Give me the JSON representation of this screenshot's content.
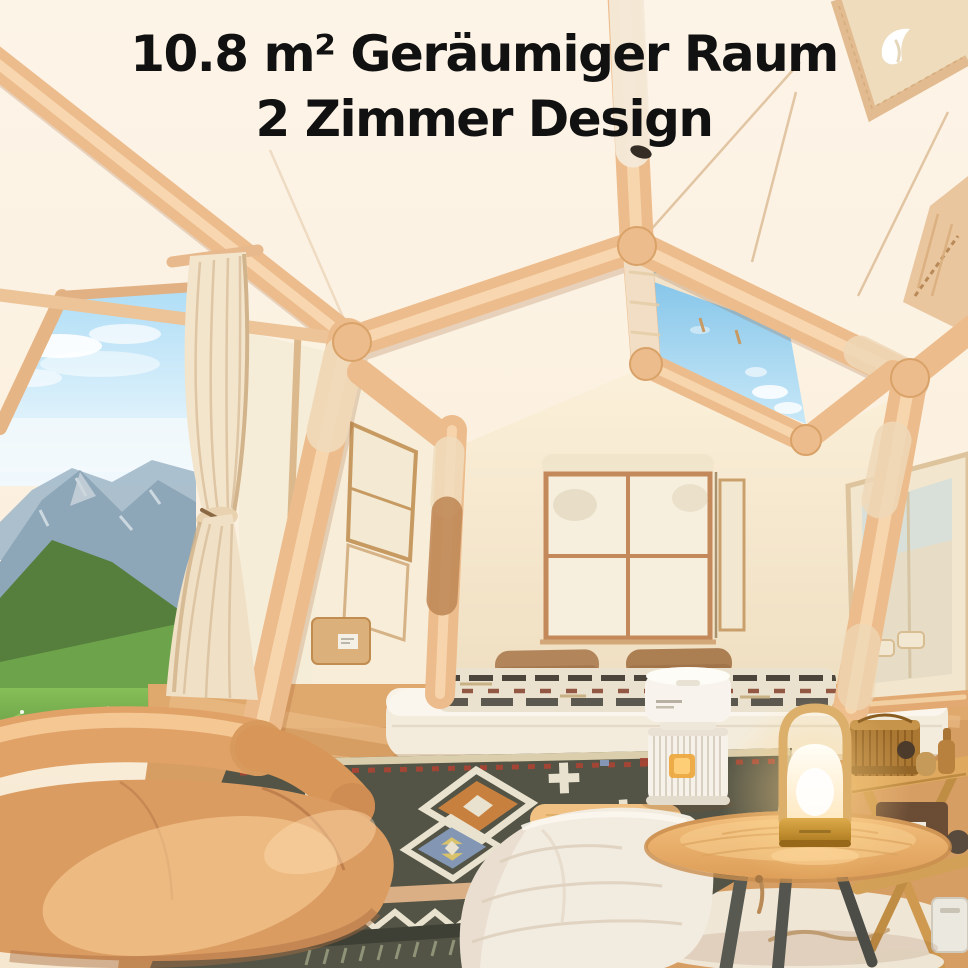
{
  "canvas": {
    "width": 968,
    "height": 968
  },
  "headline": {
    "line1": "10.8 m² Geräumiger Raum",
    "line2": "2 Zimmer Design"
  },
  "brand": {
    "logo_icon": "bird-logo-icon"
  },
  "scene": {
    "palette": {
      "headline-text": "#111111",
      "logo": "#ffffff",
      "beam": "#edbc8c",
      "beam-highlight": "#f9dcb6",
      "ceiling": "#fdf3e5",
      "wall": "#f8ecd6",
      "sky": "#8cc8ec",
      "door-sky": "#b5ddf4",
      "mountain": "#8da6b8",
      "grass": "#74b04a",
      "curtain": "#f3e4cc",
      "window-frame": "#c3895a",
      "mattress": "#f3ecdd",
      "pillow": "#b2855b",
      "rug-field": "#535446",
      "rug-cream": "#e8e2ce",
      "rug-orange": "#c8803f",
      "rug-blue": "#8397b4",
      "rug-red": "#a64534",
      "sofa": "#db9c62",
      "floor": "#d79e63",
      "table-wood": "#eeb873",
      "table-leg": "#585a52",
      "lamp-gold": "#cfa043",
      "lamp-glow": "#ffd894",
      "purifier": "#f6f2ea",
      "shelf-wood": "#dfa95f",
      "basket": "#ab7833",
      "duvet": "#f2ebdf"
    }
  }
}
